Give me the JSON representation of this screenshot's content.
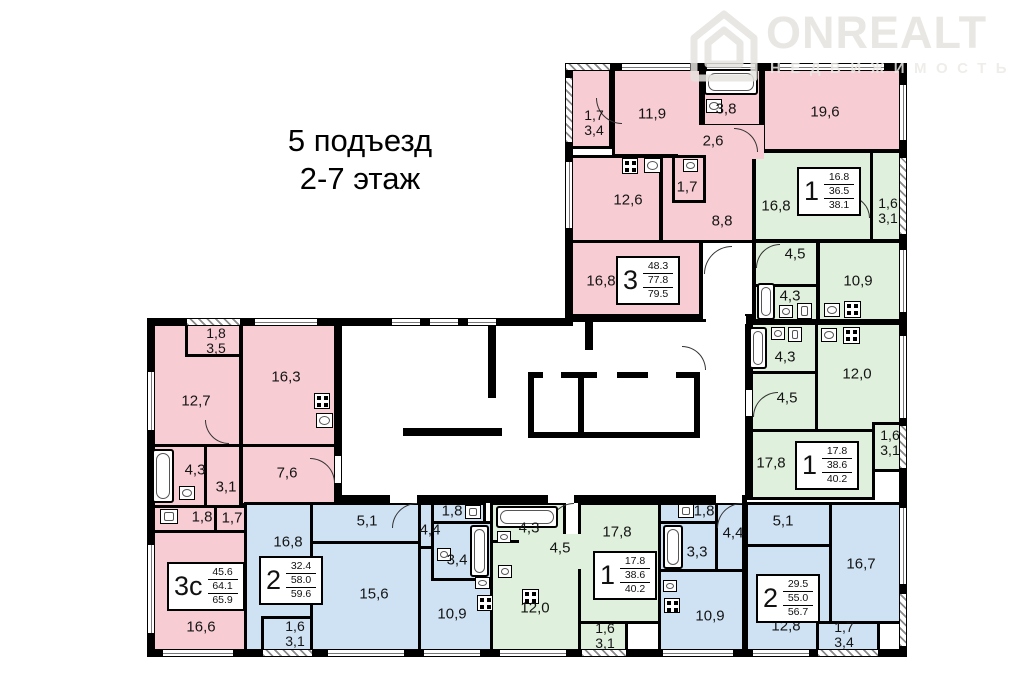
{
  "title": {
    "line1": "5 подъезд",
    "line2": "2-7 этаж"
  },
  "watermark": {
    "brand": "ONREALT",
    "subtitle": "НЕДВИЖИМОСТЬ"
  },
  "colors": {
    "pink": "#f8ccd3",
    "green": "#dff0dc",
    "blue": "#cfe2f4",
    "wall": "#000000"
  },
  "apartments": [
    {
      "type": "3",
      "living": "48.3",
      "area": "77.8",
      "total": "79.5"
    },
    {
      "type": "1",
      "living": "16.8",
      "area": "36.5",
      "total": "38.1"
    },
    {
      "type": "1",
      "living": "17.8",
      "area": "38.6",
      "total": "40.2"
    },
    {
      "type": "3с",
      "living": "45.6",
      "area": "64.1",
      "total": "65.9"
    },
    {
      "type": "2",
      "living": "32.4",
      "area": "58.0",
      "total": "59.6"
    },
    {
      "type": "1",
      "living": "17.8",
      "area": "38.6",
      "total": "40.2"
    },
    {
      "type": "2",
      "living": "29.5",
      "area": "55.0",
      "total": "56.7"
    }
  ],
  "rooms": {
    "a3_balc_1": "1,7",
    "a3_balc_2": "3,4",
    "a3_room1": "11,9",
    "a3_bath": "3,8",
    "a3_hall1": "2,6",
    "a3_room2": "19,6",
    "a3_kitchen": "12,6",
    "a3_wc": "1,7",
    "a3_hall2": "8,8",
    "a3_room3": "16,8",
    "a1a_room": "16,8",
    "a1a_balc_1": "1,6",
    "a1a_balc_2": "3,1",
    "a1a_hall": "4,5",
    "a1a_bath": "4,3",
    "a1a_kitchen": "10,9",
    "a1b_bath": "4,3",
    "a1b_kitchen": "12,0",
    "a1b_hall": "4,5",
    "a1b_room": "17,8",
    "a1b_balc_1": "1,6",
    "a1b_balc_2": "3,1",
    "a3c_balc_1": "1,8",
    "a3c_balc_2": "3,5",
    "a3c_room1": "16,3",
    "a3c_room2": "12,7",
    "a3c_bath": "4,3",
    "a3c_hall1": "3,1",
    "a3c_kitchen": "7,6",
    "a3c_wc": "1,8",
    "a3c_hall2": "1,7",
    "a3c_room3": "16,6",
    "a2a_room1": "16,8",
    "a2a_hall1": "5,1",
    "a2a_room2": "15,6",
    "a2a_balc_1": "1,6",
    "a2a_balc_2": "3,1",
    "a2a_wc": "1,8",
    "a2a_hall2": "4,4",
    "a2a_bath": "3,4",
    "a2a_kitchen": "10,9",
    "a1c_bath": "4,3",
    "a1c_hall": "4,5",
    "a1c_kitchen": "12,0",
    "a1c_room": "17,8",
    "a1c_balc_1": "1,6",
    "a1c_balc_2": "3,1",
    "a2b_wc": "1,8",
    "a2b_hall1": "4,4",
    "a2b_bath": "3,3",
    "a2b_kitchen": "10,9",
    "a2b_hall2": "5,1",
    "a2b_room1": "16,7",
    "a2b_room2": "12,8",
    "a2b_balc_1": "1,7",
    "a2b_balc_2": "3,4"
  }
}
